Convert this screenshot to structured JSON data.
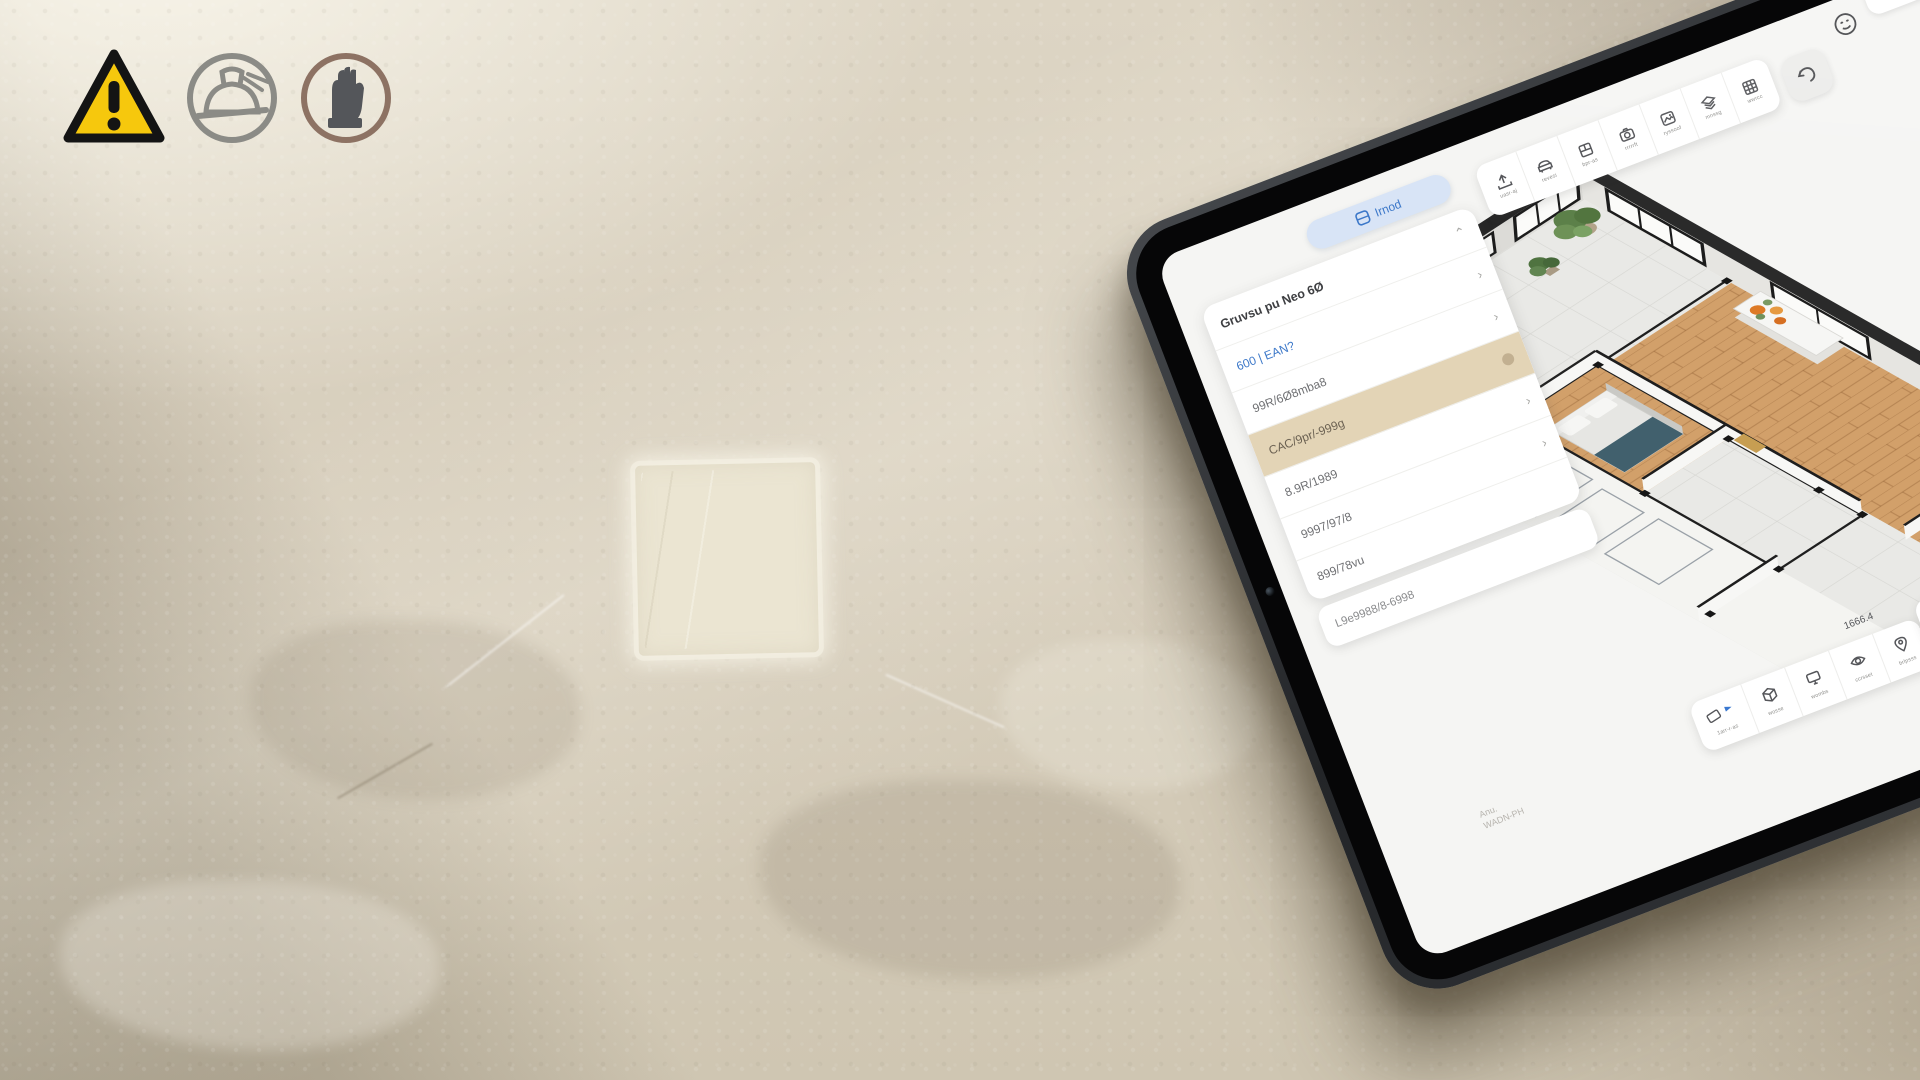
{
  "scene": {
    "wall_base_color": "#d8cfbd",
    "patch_color": "#ebe5d2",
    "safety_icons": {
      "warning": {
        "fill": "#f6c80d",
        "border": "#141414",
        "mark": "!"
      },
      "helmet_ring": "#8b8b86",
      "glove_ring": "#8d7263",
      "glove_glyph": "#54565a"
    }
  },
  "tablet": {
    "colors": {
      "accent_blue": "#3c78c9",
      "highlight_tan": "#e3d4b6",
      "wood": "#d2a06a",
      "wall_face": "#dcdbd7",
      "plant_green": "#5c8049",
      "flower_orange": "#dd7a26"
    },
    "view_tab": {
      "label": "Irnod"
    },
    "top_toolbar": {
      "buttons": [
        {
          "icon": "export-icon",
          "label": "uasr-aj"
        },
        {
          "icon": "sofa-icon",
          "label": "revesi"
        },
        {
          "icon": "cabinet-icon",
          "label": "bpr-as"
        },
        {
          "icon": "camera-icon",
          "label": "rrrrrft"
        },
        {
          "icon": "render-icon",
          "label": "ryssoof"
        },
        {
          "icon": "layers-icon",
          "label": "mnssg"
        },
        {
          "icon": "grid-icon",
          "label": "wwrcc"
        }
      ]
    },
    "panel": {
      "header": {
        "label": "Gruvsu pu Neo 6Ø",
        "caret": "⌃"
      },
      "rows": [
        {
          "label": "600 | EAN?",
          "chevron": "›"
        },
        {
          "label": "99R/6Ø8mba8",
          "chevron": "›"
        },
        {
          "label": "CAC/9pr/-999g"
        },
        {
          "label": "8.9R/1989",
          "chevron": "›"
        },
        {
          "label": "9997/97/8",
          "chevron": "›"
        },
        {
          "label": "899/78vu"
        }
      ],
      "footer_row": {
        "label": "L9e9988/8-6998"
      }
    },
    "bottom_toolbar": {
      "buttons": [
        {
          "icon": "ruler-flag-icon",
          "label": "1arr-r-as"
        },
        {
          "icon": "box-icon",
          "label": "wosse"
        },
        {
          "icon": "display-icon",
          "label": "wombs"
        },
        {
          "icon": "eye-icon",
          "label": "ccrsset"
        },
        {
          "icon": "pin-icon",
          "label": "brlpsss"
        }
      ]
    },
    "measure_label": "1666.4",
    "corner_button": {
      "label": "LSSS"
    },
    "watermark_line1": "Anu.",
    "watermark_line2": "WADN-PH"
  }
}
